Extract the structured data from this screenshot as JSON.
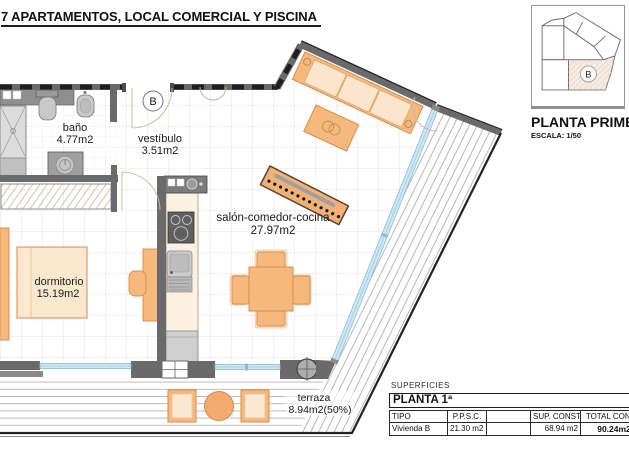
{
  "title": "7 APARTAMENTOS, LOCAL COMERCIAL Y PISCINA",
  "key_plan": {
    "unit_label": "B",
    "caption": "PLANTA PRIMERA",
    "scale": "ESCALA: 1/50"
  },
  "plan": {
    "entrance_label": "B",
    "rooms": [
      {
        "name": "baño",
        "area": "4.77m2"
      },
      {
        "name": "vestíbulo",
        "area": "3.51m2"
      },
      {
        "name": "salón-comedor-cocina",
        "area": "27.97m2"
      },
      {
        "name": "dormitorio",
        "area": "15.19m2"
      },
      {
        "name": "terraza",
        "area": "8.94m2(50%)"
      }
    ]
  },
  "surfaces": {
    "section_label": "SUPERFICIES",
    "floor_label": "PLANTA 1ª",
    "columns": [
      "TIPO",
      "P.P.S.C.",
      "",
      "SUP. CONST.",
      "TOTAL CONST."
    ],
    "rows": [
      {
        "tipo": "Vivienda B",
        "ppsc": "21.30 m2",
        "blank": "",
        "sup_const": "68.94 m2",
        "total": "90.24m2"
      }
    ]
  },
  "colors": {
    "furniture_orange": "#f5b97e",
    "cushion_cream": "#fbe5cd",
    "wall_gray": "#6a6a6a",
    "glass_blue": "#cfe8f4",
    "hatch_gray": "#b0b0b0"
  }
}
